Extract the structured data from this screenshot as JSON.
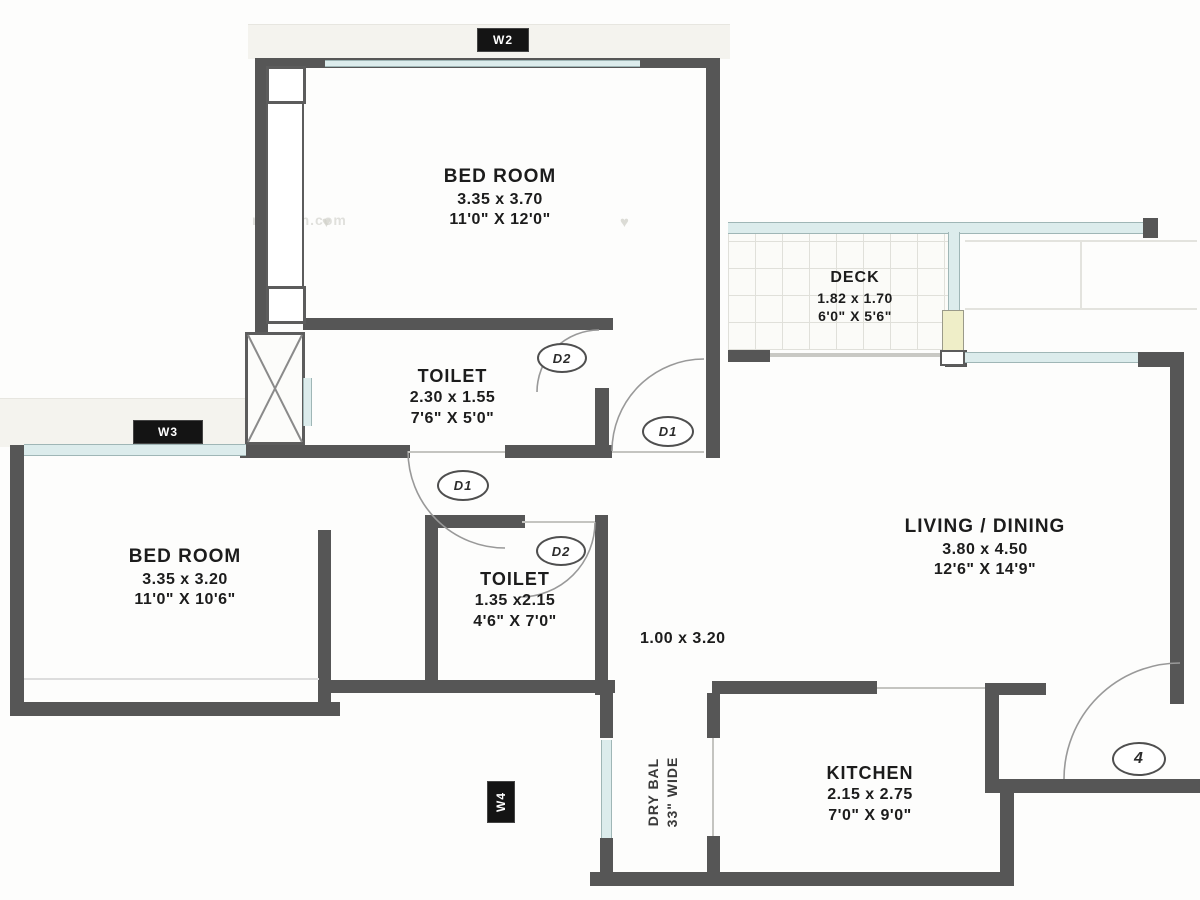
{
  "rooms": [
    {
      "id": "bedroom1",
      "name": "BED ROOM",
      "metric": "3.35 x 3.70",
      "imperial": "11'0\" X 12'0\""
    },
    {
      "id": "deck",
      "name": "DECK",
      "metric": "1.82 x 1.70",
      "imperial": "6'0\" X 5'6\""
    },
    {
      "id": "toilet1",
      "name": "TOILET",
      "metric": "2.30 x 1.55",
      "imperial": "7'6\" X 5'0\""
    },
    {
      "id": "bedroom2",
      "name": "BED ROOM",
      "metric": "3.35 x 3.20",
      "imperial": "11'0\" X 10'6\""
    },
    {
      "id": "toilet2",
      "name": "TOILET",
      "metric": "1.35 x2.15",
      "imperial": "4'6\" X 7'0\""
    },
    {
      "id": "living",
      "name": "LIVING / DINING",
      "metric": "3.80 x 4.50",
      "imperial": "12'6\" X 14'9\""
    },
    {
      "id": "kitchen",
      "name": "KITCHEN",
      "metric": "2.15 x 2.75",
      "imperial": "7'0\" X 9'0\""
    }
  ],
  "passage": {
    "label": "1.00 x 3.20"
  },
  "drybal": {
    "line1": "DRY BAL",
    "line2": "33\" WIDE"
  },
  "windows": {
    "w2": "W2",
    "w3": "W3",
    "w4": "W4"
  },
  "doors": {
    "d1": "D1",
    "d2": "D2",
    "entrance": "4"
  },
  "watermark": {
    "text": "makaan.com",
    "heart": "♥"
  },
  "colors": {
    "wall": "#565656",
    "window": "#dcecec"
  }
}
